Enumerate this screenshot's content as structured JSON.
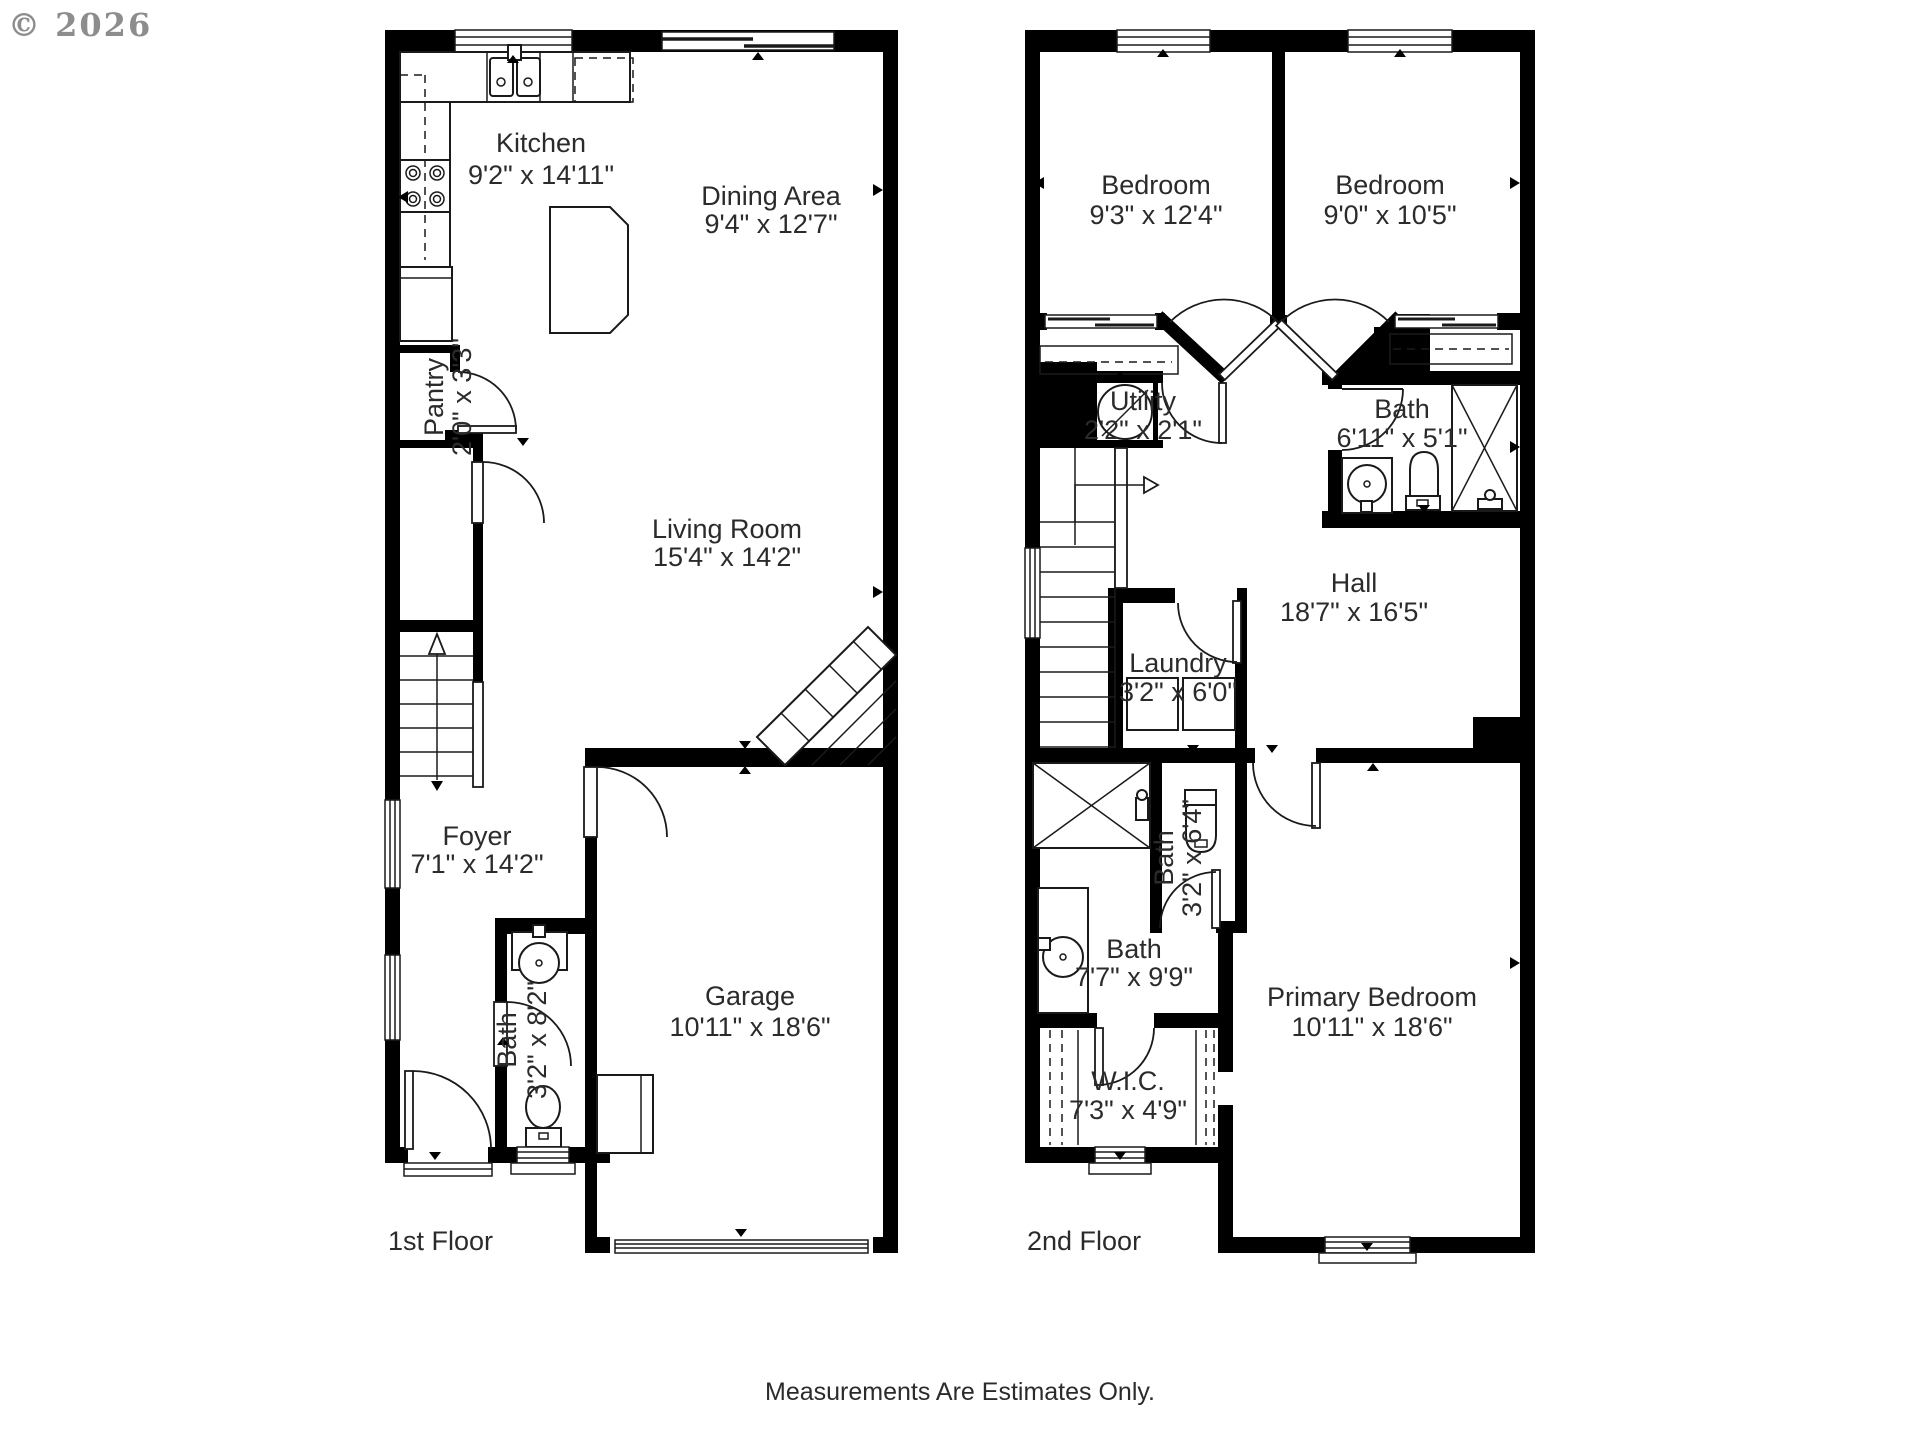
{
  "copyright": "© 2026",
  "footer_note": "Measurements Are Estimates Only.",
  "floor1": {
    "label": "1st Floor",
    "rooms": {
      "kitchen": {
        "name": "Kitchen",
        "dims": "9'2\" x 14'11\""
      },
      "dining": {
        "name": "Dining Area",
        "dims": "9'4\" x 12'7\""
      },
      "pantry": {
        "name": "Pantry",
        "dims": "2'0\" x 3'3\""
      },
      "living": {
        "name": "Living Room",
        "dims": "15'4\" x 14'2\""
      },
      "foyer": {
        "name": "Foyer",
        "dims": "7'1\" x 14'2\""
      },
      "bath": {
        "name": "Bath",
        "dims": "3'2\" x 8'2\""
      },
      "garage": {
        "name": "Garage",
        "dims": "10'11\" x 18'6\""
      }
    }
  },
  "floor2": {
    "label": "2nd Floor",
    "rooms": {
      "bedroom_left": {
        "name": "Bedroom",
        "dims": "9'3\" x 12'4\""
      },
      "bedroom_right": {
        "name": "Bedroom",
        "dims": "9'0\" x 10'5\""
      },
      "utility": {
        "name": "Utility",
        "dims": "2'2\" x 2'1\""
      },
      "bath_upper": {
        "name": "Bath",
        "dims": "6'11\" x 5'1\""
      },
      "hall": {
        "name": "Hall",
        "dims": "18'7\" x 16'5\""
      },
      "laundry": {
        "name": "Laundry",
        "dims": "3'2\" x 6'0\""
      },
      "bath_wc": {
        "name": "Bath",
        "dims": "3'2\" x 6'4\""
      },
      "bath_main": {
        "name": "Bath",
        "dims": "7'7\" x 9'9\""
      },
      "primary": {
        "name": "Primary Bedroom",
        "dims": "10'11\" x 18'6\""
      },
      "wic": {
        "name": "W.I.C.",
        "dims": "7'3\" x 4'9\""
      }
    }
  }
}
